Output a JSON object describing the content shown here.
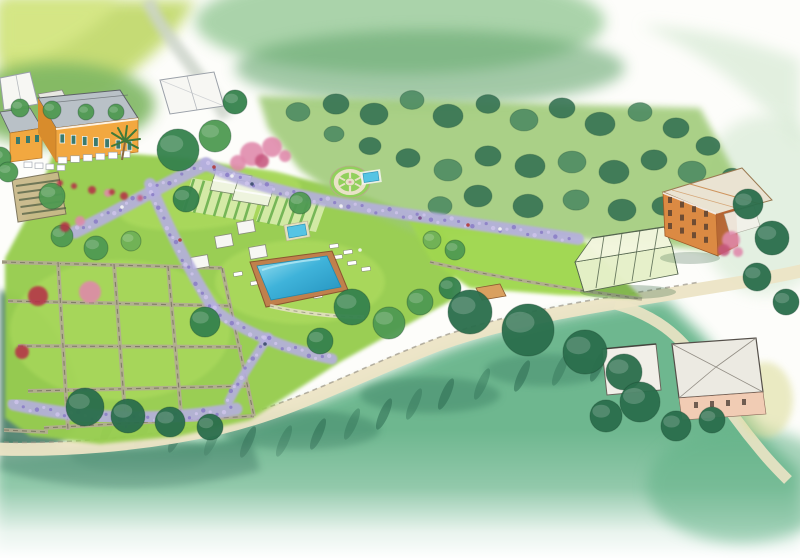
{
  "scene_title": "Watercolor aerial illustration of a terraced Mediterranean estate with villa, gardens, olive grove, swimming pool, greenhouses and coastal road",
  "palette": {
    "paper": "#fdfdfa",
    "hill_lime": "#c3da6e",
    "hill_lime_bright": "#d7e887",
    "hill_green": "#7fb763",
    "hill_road_gray": "#ccd4ca",
    "top_wash": "#8fc690",
    "top_wash_dark": "#66a770",
    "pale_wash": "#d9ebd7",
    "grove_ground": "#9cc973",
    "olive_dark": "#337152",
    "olive_mid": "#4c8a62",
    "lawn": "#97cd50",
    "lawn_bright": "#b6e163",
    "lawn_right": "#a0d74f",
    "wisteria": "#b5afdf",
    "wisteria_deep": "#8678c4",
    "wisteria_light": "#cfc6ec",
    "stone_path": "#e9e2c7",
    "stone_wall": "#b3ac93",
    "wall_line": "#75705e",
    "pool_deck": "#c27c4c",
    "small_pool": "#55c4e4",
    "villa_orange": "#f2a840",
    "villa_shade": "#d88c2c",
    "roof_gray": "#b9c1c7",
    "roof_line": "#5c6166",
    "terracotta": "#db8a43",
    "terracotta_shade": "#b5612e",
    "roof_pale": "#eae3d2",
    "glass_green": "#e6f0c9",
    "glass_roof": "#f2f6dd",
    "glass_frame": "#55664f",
    "flower_red": "#b53246",
    "flower_pink": "#e088ab",
    "flower_deep": "#c6567e",
    "canopy_white": "#f7f7f3",
    "tree_light": "#6fb157",
    "tree_mid": "#4f9a52",
    "tree_dark": "#35824d",
    "tree_deep": "#2a6e4c",
    "cypress": "#2e6b52",
    "hillside": "#62b287",
    "hillside_teal": "#3f8568",
    "road": "#ece4c5",
    "white_building": "#eceae2",
    "building_pink": "#f1ccb4",
    "court_soil": "#c9b98a"
  },
  "scene": {
    "grove_trees": [
      [
        298,
        112,
        12
      ],
      [
        336,
        104,
        13
      ],
      [
        374,
        114,
        14
      ],
      [
        412,
        100,
        12
      ],
      [
        448,
        116,
        15
      ],
      [
        488,
        104,
        12
      ],
      [
        524,
        120,
        14
      ],
      [
        562,
        108,
        13
      ],
      [
        600,
        124,
        15
      ],
      [
        640,
        112,
        12
      ],
      [
        676,
        128,
        13
      ],
      [
        708,
        146,
        12
      ],
      [
        692,
        172,
        14
      ],
      [
        654,
        160,
        13
      ],
      [
        614,
        172,
        15
      ],
      [
        572,
        162,
        14
      ],
      [
        530,
        166,
        15
      ],
      [
        488,
        156,
        13
      ],
      [
        448,
        170,
        14
      ],
      [
        408,
        158,
        12
      ],
      [
        370,
        146,
        11
      ],
      [
        334,
        134,
        10
      ],
      [
        478,
        196,
        14
      ],
      [
        528,
        206,
        15
      ],
      [
        576,
        200,
        13
      ],
      [
        622,
        210,
        14
      ],
      [
        664,
        206,
        12
      ],
      [
        440,
        206,
        12
      ],
      [
        700,
        200,
        11
      ],
      [
        732,
        176,
        10
      ]
    ],
    "estate_trees": [
      [
        0,
        158,
        11,
        "mid"
      ],
      [
        8,
        172,
        10,
        "mid"
      ],
      [
        52,
        196,
        13,
        "mid"
      ],
      [
        62,
        236,
        11,
        "mid"
      ],
      [
        96,
        248,
        12,
        "mid"
      ],
      [
        131,
        241,
        10,
        "light"
      ],
      [
        178,
        150,
        21,
        "dark"
      ],
      [
        215,
        136,
        16,
        "mid"
      ],
      [
        235,
        102,
        12,
        "dark"
      ],
      [
        186,
        199,
        13,
        "dark"
      ],
      [
        205,
        322,
        15,
        "dark"
      ],
      [
        352,
        307,
        18,
        "dark"
      ],
      [
        389,
        323,
        16,
        "mid"
      ],
      [
        320,
        341,
        13,
        "dark"
      ],
      [
        420,
        302,
        13,
        "mid"
      ],
      [
        300,
        203,
        11,
        "mid"
      ],
      [
        450,
        288,
        11,
        "dark"
      ],
      [
        85,
        407,
        19,
        "deep"
      ],
      [
        128,
        416,
        17,
        "deep"
      ],
      [
        170,
        422,
        15,
        "deep"
      ],
      [
        210,
        427,
        13,
        "deep"
      ],
      [
        470,
        312,
        22,
        "deep"
      ],
      [
        528,
        330,
        26,
        "deep"
      ],
      [
        585,
        352,
        22,
        "deep"
      ],
      [
        624,
        372,
        18,
        "deep"
      ],
      [
        640,
        402,
        20,
        "deep"
      ],
      [
        606,
        416,
        16,
        "deep"
      ],
      [
        676,
        426,
        15,
        "deep"
      ],
      [
        712,
        420,
        13,
        "deep"
      ],
      [
        748,
        204,
        15,
        "deep"
      ],
      [
        772,
        238,
        17,
        "deep"
      ],
      [
        757,
        277,
        14,
        "deep"
      ],
      [
        786,
        302,
        13,
        "deep"
      ],
      [
        455,
        250,
        10,
        "mid"
      ],
      [
        432,
        240,
        9,
        "light"
      ],
      [
        20,
        108,
        9,
        "mid"
      ],
      [
        52,
        110,
        9,
        "mid"
      ],
      [
        86,
        112,
        8,
        "mid"
      ],
      [
        116,
        112,
        8,
        "mid"
      ]
    ],
    "cypresses": [
      [
        108,
        428
      ],
      [
        142,
        433
      ],
      [
        176,
        437
      ],
      [
        212,
        440
      ],
      [
        248,
        442
      ],
      [
        284,
        441
      ],
      [
        318,
        434
      ],
      [
        352,
        424
      ],
      [
        384,
        414
      ],
      [
        414,
        404
      ],
      [
        446,
        394
      ],
      [
        482,
        384
      ],
      [
        522,
        376
      ],
      [
        560,
        370
      ],
      [
        598,
        366
      ],
      [
        634,
        366
      ]
    ],
    "terrace_walls": [
      [
        2,
        262,
        222,
        268
      ],
      [
        8,
        301,
        232,
        306
      ],
      [
        18,
        346,
        242,
        347
      ],
      [
        28,
        391,
        250,
        386
      ],
      [
        44,
        428,
        254,
        416
      ],
      [
        58,
        262,
        68,
        430
      ],
      [
        114,
        264,
        126,
        428
      ],
      [
        168,
        266,
        182,
        424
      ],
      [
        222,
        268,
        254,
        416
      ],
      [
        4,
        430,
        48,
        432
      ]
    ],
    "wisteria_paths": {
      "w1a": "M75,232 C115,213 160,186 206,164",
      "w1b": "M206,164 C240,182 300,197 360,207 C430,219 500,227 578,239",
      "w2a": "M150,184 C163,216 185,263 213,308",
      "w2b": "M213,308 C240,331 285,349 332,359",
      "w2c": "M268,337 C255,357 240,379 229,401",
      "w3": "M14,404 C80,419 155,423 236,409"
    },
    "loungers": [
      [
        338,
        257,
        -8
      ],
      [
        352,
        263,
        -8
      ],
      [
        366,
        269,
        -8
      ],
      [
        334,
        246,
        -8
      ],
      [
        348,
        252,
        -8
      ],
      [
        300,
        288,
        -10
      ],
      [
        284,
        278,
        -10
      ],
      [
        255,
        283,
        -10
      ],
      [
        238,
        274,
        -10
      ],
      [
        318,
        296,
        -10
      ]
    ],
    "cabanas": [
      [
        246,
        227
      ],
      [
        224,
        241
      ],
      [
        258,
        252
      ],
      [
        200,
        262
      ]
    ],
    "people": [
      [
        214,
        167,
        "#b03a3a"
      ],
      [
        232,
        176,
        "#f5f5f5"
      ],
      [
        252,
        184,
        "#3a4a6a"
      ],
      [
        300,
        197,
        "#b03a3a"
      ],
      [
        341,
        206,
        "#f5f5f5"
      ],
      [
        420,
        218,
        "#7a4a8a"
      ],
      [
        468,
        225,
        "#b03a3a"
      ],
      [
        500,
        229,
        "#f5f5f5"
      ],
      [
        122,
        207,
        "#f5f5f5"
      ],
      [
        265,
        344,
        "#3a4a6a"
      ],
      [
        180,
        240,
        "#b03a3a"
      ],
      [
        360,
        250,
        "#f5f5f5"
      ]
    ],
    "flowers": [
      [
        38,
        296,
        10,
        "red"
      ],
      [
        90,
        292,
        11,
        "pink"
      ],
      [
        22,
        352,
        7,
        "red"
      ],
      [
        80,
        221,
        5,
        "pink"
      ],
      [
        65,
        227,
        5,
        "red"
      ],
      [
        252,
        154,
        12,
        "pink"
      ],
      [
        272,
        147,
        10,
        "pink"
      ],
      [
        238,
        163,
        8,
        "pink"
      ],
      [
        262,
        161,
        7,
        "deep"
      ],
      [
        285,
        156,
        6,
        "pink"
      ],
      [
        92,
        190,
        4,
        "red"
      ],
      [
        108,
        193,
        4,
        "pink"
      ],
      [
        124,
        196,
        4,
        "red"
      ],
      [
        140,
        198,
        3,
        "deep"
      ],
      [
        731,
        240,
        9,
        "pink"
      ],
      [
        724,
        250,
        6,
        "deep"
      ],
      [
        738,
        252,
        5,
        "pink"
      ],
      [
        60,
        183,
        3,
        "red"
      ],
      [
        74,
        186,
        3,
        "red"
      ],
      [
        112,
        192,
        3,
        "red"
      ]
    ]
  }
}
